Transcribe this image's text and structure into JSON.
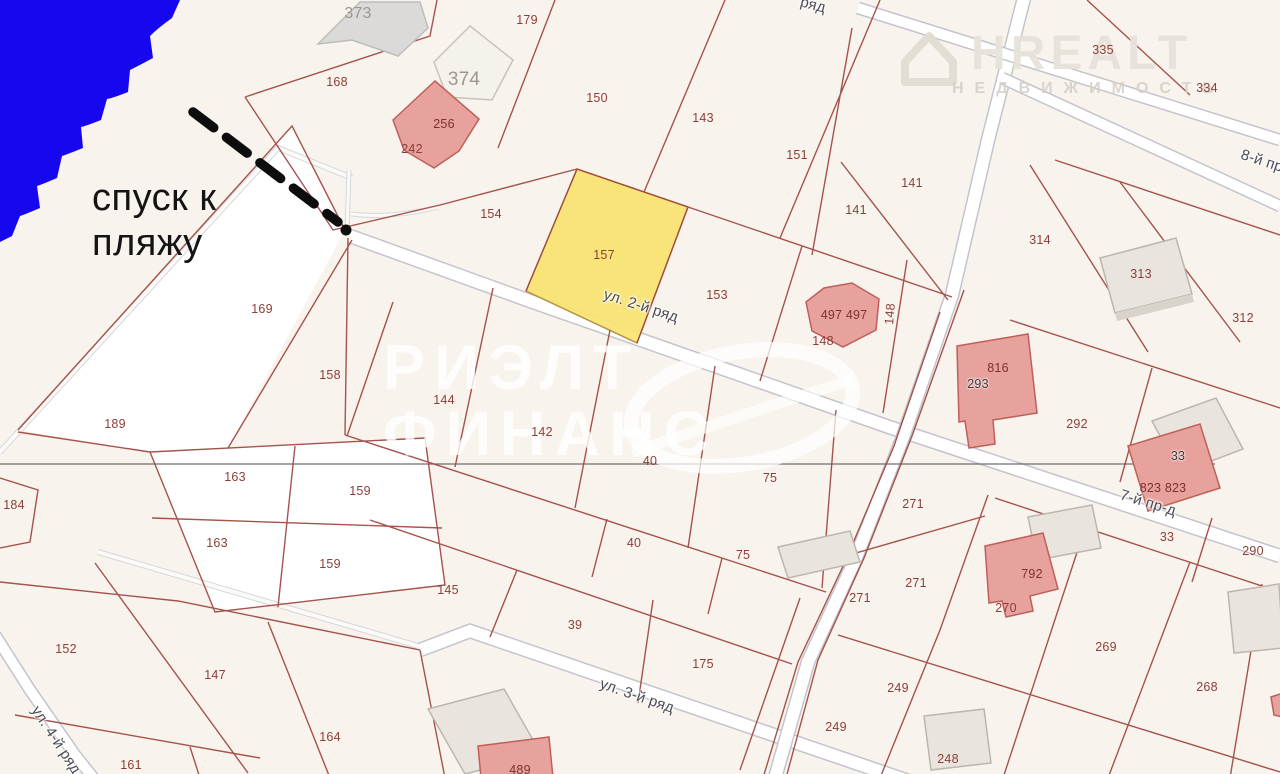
{
  "map": {
    "background_color": "#f8f3ec",
    "water_color": "#1607ee",
    "boundary_color": "#a04a43",
    "highlight": {
      "plot": "157",
      "color": "#f8e370"
    },
    "beach_note": {
      "line1": "спуск к",
      "line2": "пляжу"
    },
    "watermark_center": {
      "line1": "РИЭЛТ",
      "line2": "ФИНАНС"
    },
    "watermark_corner": {
      "brand": "НREALT",
      "subtitle": "НЕДВИЖИМОСТЬ"
    },
    "labels": [
      {
        "t": "373",
        "x": 358,
        "y": 14,
        "c": "gray"
      },
      {
        "t": "374",
        "x": 464,
        "y": 80,
        "c": "gray-lg"
      },
      {
        "t": "168",
        "x": 337,
        "y": 82
      },
      {
        "t": "179",
        "x": 527,
        "y": 20
      },
      {
        "t": "150",
        "x": 597,
        "y": 98
      },
      {
        "t": "143",
        "x": 703,
        "y": 118
      },
      {
        "t": "151",
        "x": 797,
        "y": 155
      },
      {
        "t": "141",
        "x": 912,
        "y": 183
      },
      {
        "t": "141",
        "x": 856,
        "y": 210
      },
      {
        "t": "335",
        "x": 1103,
        "y": 50
      },
      {
        "t": "334",
        "x": 1207,
        "y": 88
      },
      {
        "t": "256",
        "x": 444,
        "y": 124,
        "c": "bldg"
      },
      {
        "t": "242",
        "x": 412,
        "y": 149
      },
      {
        "t": "154",
        "x": 491,
        "y": 214
      },
      {
        "t": "157",
        "x": 604,
        "y": 255
      },
      {
        "t": "153",
        "x": 717,
        "y": 295
      },
      {
        "t": "497 497",
        "x": 844,
        "y": 315,
        "c": "bldg"
      },
      {
        "t": "148",
        "x": 823,
        "y": 341
      },
      {
        "t": "148",
        "x": 890,
        "y": 314,
        "r": -85
      },
      {
        "t": "314",
        "x": 1040,
        "y": 240
      },
      {
        "t": "313",
        "x": 1141,
        "y": 274
      },
      {
        "t": "312",
        "x": 1243,
        "y": 318
      },
      {
        "t": "816",
        "x": 998,
        "y": 368,
        "c": "bldg"
      },
      {
        "t": "293",
        "x": 978,
        "y": 384,
        "c": "dark"
      },
      {
        "t": "292",
        "x": 1077,
        "y": 424
      },
      {
        "t": "169",
        "x": 262,
        "y": 309
      },
      {
        "t": "158",
        "x": 330,
        "y": 375
      },
      {
        "t": "144",
        "x": 444,
        "y": 400
      },
      {
        "t": "142",
        "x": 542,
        "y": 432
      },
      {
        "t": "189",
        "x": 115,
        "y": 424
      },
      {
        "t": "40",
        "x": 650,
        "y": 461
      },
      {
        "t": "75",
        "x": 770,
        "y": 478
      },
      {
        "t": "271",
        "x": 913,
        "y": 504
      },
      {
        "t": "33",
        "x": 1178,
        "y": 456,
        "c": "dark"
      },
      {
        "t": "823 823",
        "x": 1163,
        "y": 488,
        "c": "bldg"
      },
      {
        "t": "163",
        "x": 235,
        "y": 477
      },
      {
        "t": "159",
        "x": 360,
        "y": 491
      },
      {
        "t": "184",
        "x": 14,
        "y": 505
      },
      {
        "t": "163",
        "x": 217,
        "y": 543
      },
      {
        "t": "159",
        "x": 330,
        "y": 564
      },
      {
        "t": "40",
        "x": 634,
        "y": 543
      },
      {
        "t": "75",
        "x": 743,
        "y": 555
      },
      {
        "t": "33",
        "x": 1167,
        "y": 537
      },
      {
        "t": "290",
        "x": 1253,
        "y": 551
      },
      {
        "t": "271",
        "x": 916,
        "y": 583
      },
      {
        "t": "271",
        "x": 860,
        "y": 598
      },
      {
        "t": "792",
        "x": 1032,
        "y": 574,
        "c": "bldg"
      },
      {
        "t": "270",
        "x": 1006,
        "y": 608
      },
      {
        "t": "145",
        "x": 448,
        "y": 590
      },
      {
        "t": "39",
        "x": 575,
        "y": 625
      },
      {
        "t": "269",
        "x": 1106,
        "y": 647
      },
      {
        "t": "268",
        "x": 1207,
        "y": 687
      },
      {
        "t": "175",
        "x": 703,
        "y": 664
      },
      {
        "t": "249",
        "x": 898,
        "y": 688
      },
      {
        "t": "249",
        "x": 836,
        "y": 727
      },
      {
        "t": "248",
        "x": 948,
        "y": 759
      },
      {
        "t": "152",
        "x": 66,
        "y": 649
      },
      {
        "t": "147",
        "x": 215,
        "y": 675
      },
      {
        "t": "161",
        "x": 131,
        "y": 765
      },
      {
        "t": "164",
        "x": 330,
        "y": 737
      },
      {
        "t": "489",
        "x": 520,
        "y": 770,
        "c": "bldg"
      },
      {
        "t": "ул. 2-й ряд",
        "x": 641,
        "y": 306,
        "c": "street",
        "r": 18
      },
      {
        "t": "ул. 3-й ряд",
        "x": 637,
        "y": 696,
        "c": "street",
        "r": 19
      },
      {
        "t": "ул. 4-й ряд",
        "x": 56,
        "y": 740,
        "c": "street",
        "r": 57
      },
      {
        "t": "8-й пр",
        "x": 1262,
        "y": 161,
        "c": "street",
        "r": 18
      },
      {
        "t": "7-й пр-д",
        "x": 1148,
        "y": 503,
        "c": "street",
        "r": 17
      },
      {
        "t": "ряд",
        "x": 813,
        "y": 5,
        "c": "street",
        "r": 15
      }
    ]
  }
}
